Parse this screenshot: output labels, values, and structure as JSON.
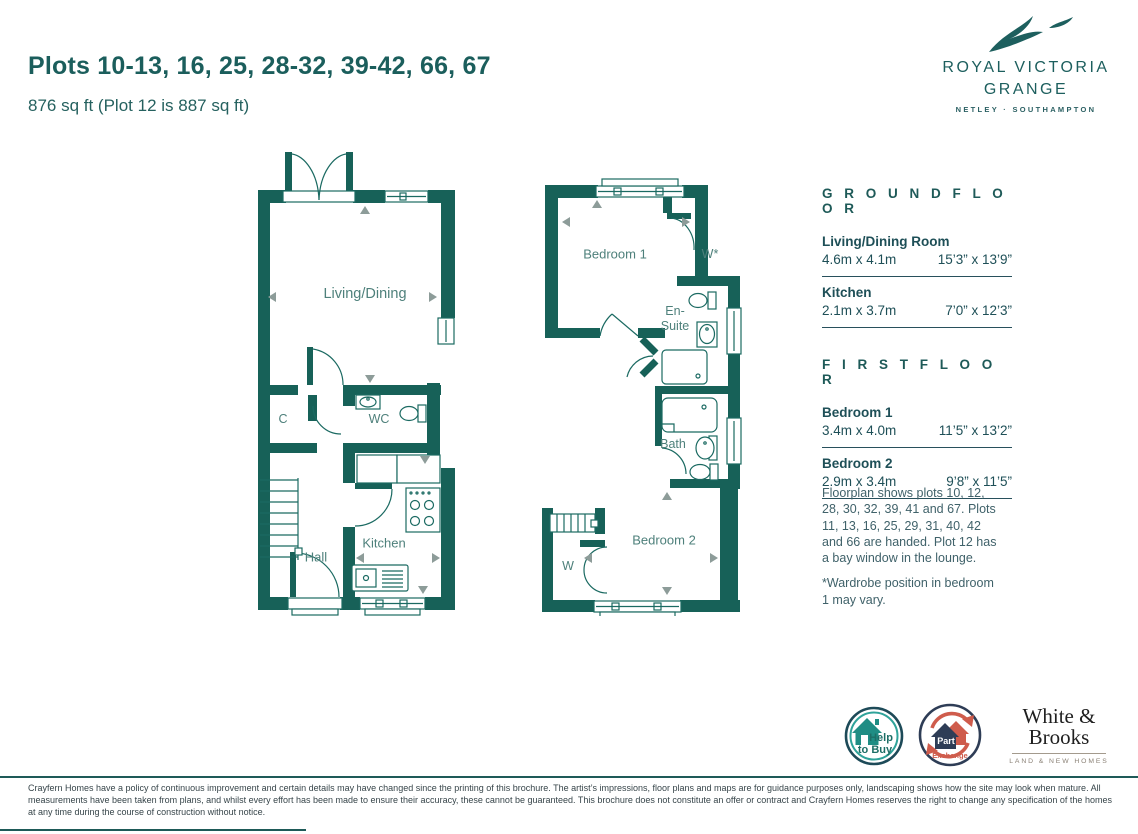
{
  "page": {
    "title": "Plots 10-13, 16, 25, 28-32, 39-42, 66, 67",
    "subtitle": "876 sq ft (Plot 12 is 887 sq ft)"
  },
  "brand": {
    "name_line1": "ROYAL VICTORIA",
    "name_line2": "GRANGE",
    "location": "NETLEY · SOUTHAMPTON"
  },
  "colors": {
    "wall_teal": "#176158",
    "text_teal": "#1e5a58",
    "label_teal": "#4e807b",
    "arrow_gray": "#8d9c99",
    "part_exchange_red": "#cf5c4c",
    "part_exchange_navy": "#2e3d56",
    "help_to_buy_teal": "#2fa39a"
  },
  "ground_plan_labels": {
    "living": "Living/Dining",
    "cupboard": "C",
    "wc": "WC",
    "hall": "Hall",
    "kitchen": "Kitchen"
  },
  "first_plan_labels": {
    "bedroom1": "Bedroom 1",
    "wardrobe1": "W*",
    "ensuite_line1": "En-",
    "ensuite_line2": "Suite",
    "bath": "Bath",
    "bedroom2": "Bedroom 2",
    "wardrobe2": "W"
  },
  "ground_floor": {
    "heading": "G R O U N D   F L O O R",
    "rooms": [
      {
        "name": "Living/Dining Room",
        "metric": "4.6m x 4.1m",
        "imperial": "15’3” x 13’9”"
      },
      {
        "name": "Kitchen",
        "metric": "2.1m x 3.7m",
        "imperial": "7’0” x 12’3”"
      }
    ]
  },
  "first_floor": {
    "heading": "F I R S T   F L O O R",
    "rooms": [
      {
        "name": "Bedroom 1",
        "metric": "3.4m x 4.0m",
        "imperial": "11’5” x 13’2”"
      },
      {
        "name": "Bedroom 2",
        "metric": "2.9m x 3.4m",
        "imperial": "9’8” x 11’5”"
      }
    ]
  },
  "notes": {
    "paragraph1": "Floorplan shows plots 10, 12, 28, 30, 32, 39, 41 and 67. Plots 11, 13, 16, 25, 29, 31, 40, 42 and 66 are handed. Plot 12 has a bay window in the lounge.",
    "paragraph2": "*Wardrobe position in bedroom 1 may vary."
  },
  "badges": {
    "help_to_buy": {
      "line1": "Help",
      "line2": "to Buy"
    },
    "part_exchange": {
      "line1": "Part",
      "line2": "Exchange"
    },
    "agent": {
      "name_line1": "White &",
      "name_line2": "Brooks",
      "tagline": "LAND & NEW HOMES"
    }
  },
  "disclaimer": "Crayfern Homes have a policy of continuous improvement and certain details may have changed since the printing of this brochure. The artist’s impressions, floor plans and maps are for guidance purposes only, landscaping shows how the site may look when mature. All measurements have been taken from plans, and whilst every effort has been made to ensure their accuracy, these cannot be guaranteed. This brochure does not constitute an offer or contract and Crayfern Homes reserves the right to change any specification of the homes at any time during the course of construction without notice."
}
